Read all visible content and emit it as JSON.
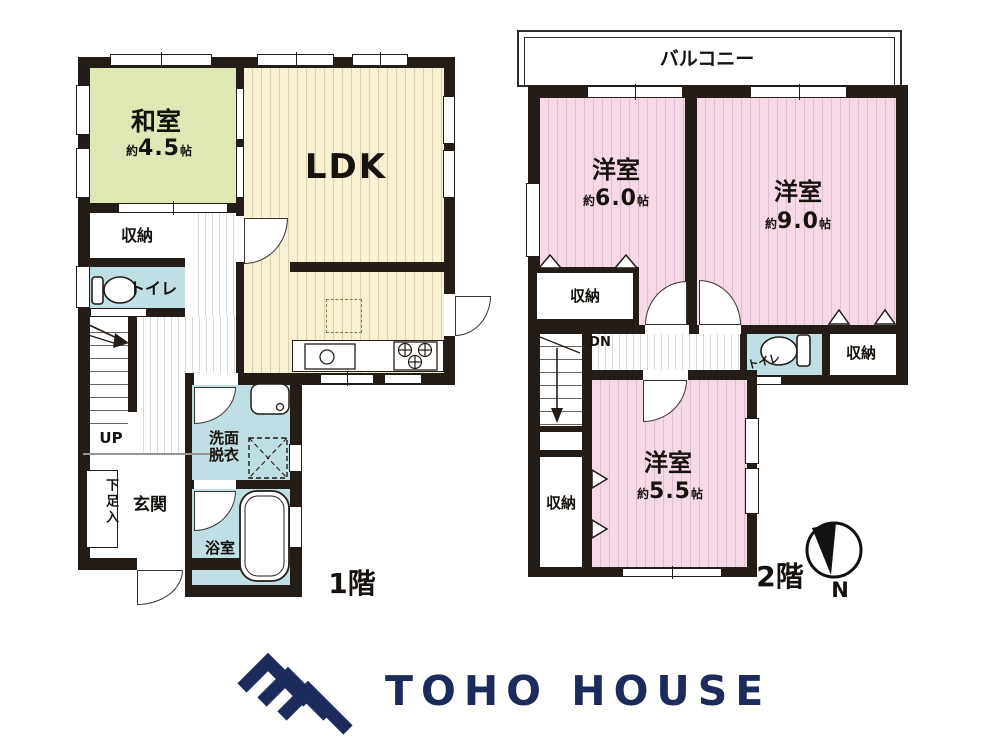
{
  "floor1": {
    "floor_label": "1階",
    "washitsu": {
      "name": "和室",
      "size_prefix": "約",
      "size_value": "4.5",
      "size_unit": "帖"
    },
    "ldk": {
      "name": "LDK"
    },
    "closet": {
      "name": "収納"
    },
    "toilet": {
      "name": "トイレ"
    },
    "stairs": {
      "direction": "UP"
    },
    "genkan": {
      "name": "玄関"
    },
    "shoe_box": {
      "name": "下足入"
    },
    "washroom": {
      "name_line1": "洗面",
      "name_line2": "脱衣"
    },
    "bathroom": {
      "name": "浴室"
    }
  },
  "floor2": {
    "floor_label": "2階",
    "balcony": {
      "name": "バルコニー"
    },
    "bedroom6": {
      "name": "洋室",
      "size_prefix": "約",
      "size_value": "6.0",
      "size_unit": "帖"
    },
    "bedroom9": {
      "name": "洋室",
      "size_prefix": "約",
      "size_value": "9.0",
      "size_unit": "帖"
    },
    "bedroom55": {
      "name": "洋室",
      "size_prefix": "約",
      "size_value": "5.5",
      "size_unit": "帖"
    },
    "closet_a": {
      "name": "収納"
    },
    "closet_b": {
      "name": "収納"
    },
    "closet_c": {
      "name": "収納"
    },
    "toilet": {
      "name": "トイレ"
    },
    "stairs": {
      "direction": "DN"
    }
  },
  "compass": {
    "north_label": "N"
  },
  "logo": {
    "brand": "TOHO HOUSE"
  },
  "colors": {
    "wall": "#241c16",
    "tatami_room_green": "#dde8b5",
    "ldk_cream": "#f8f1d4",
    "bedroom_pink": "#f6d9e6",
    "wet_room_blue": "#bfdfe5",
    "logo_navy": "#1c2a5c"
  }
}
